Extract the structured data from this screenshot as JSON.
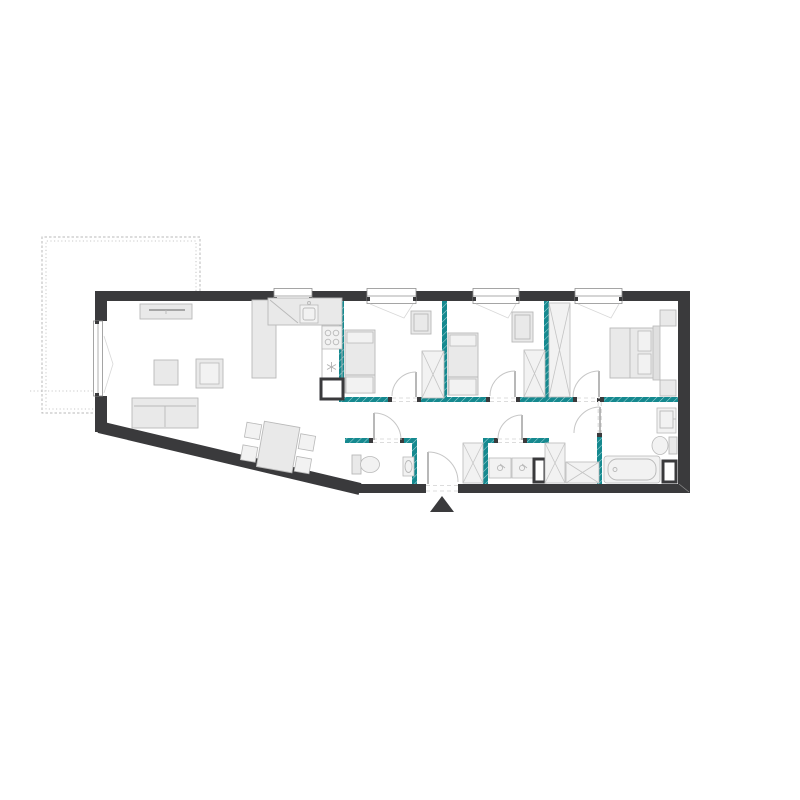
{
  "title": "apartment-floor-plan",
  "colors": {
    "background": "#ffffff",
    "wall": "#3a3a3c",
    "plumbing_wall": "#15898f",
    "furniture_fill": "#e9e9e9",
    "furniture_stroke": "#b9b9b9",
    "window_stroke": "#8f8f8f",
    "door_arc": "#c6c6c6",
    "dash": "#dcdcdc",
    "terrace_dash": "#b8b8b8",
    "entrance_marker": "#3a3a3c"
  },
  "plan": {
    "counts": {
      "top_windows": 4,
      "balcony_doors": 1,
      "interior_doors": 6,
      "entrance_doors": 1
    },
    "areas": [
      {
        "name": "terrace",
        "items": []
      },
      {
        "name": "living-room",
        "items": [
          "sofa",
          "armchair",
          "coffee-table",
          "tv-sideboard",
          "dining-table",
          "dining-chairs-x4"
        ]
      },
      {
        "name": "kitchen",
        "items": [
          "l-counter",
          "kitchen-sink",
          "cooktop-4-burners",
          "appliance-snowflake",
          "vent-shaft"
        ]
      },
      {
        "name": "bedroom-1",
        "items": [
          "single-bed",
          "dresser",
          "wardrobe"
        ]
      },
      {
        "name": "bedroom-2",
        "items": [
          "single-bed",
          "dresser",
          "wardrobe"
        ]
      },
      {
        "name": "bedroom-3",
        "items": [
          "double-bed",
          "nightstand-x2",
          "wardrobe"
        ]
      },
      {
        "name": "hallway",
        "items": [
          "cabinet",
          "wardrobe-low"
        ]
      },
      {
        "name": "wc",
        "items": [
          "toilet",
          "washbasin"
        ]
      },
      {
        "name": "bathroom-middle",
        "items": [
          "cabinet",
          "washbasin-x2",
          "vent-shaft"
        ]
      },
      {
        "name": "bathroom-right",
        "items": [
          "washbasin",
          "toilet",
          "bathtub",
          "vent-shaft"
        ]
      }
    ],
    "entrance": {
      "marker": "entrance-triangle",
      "position": "bottom-center"
    }
  }
}
